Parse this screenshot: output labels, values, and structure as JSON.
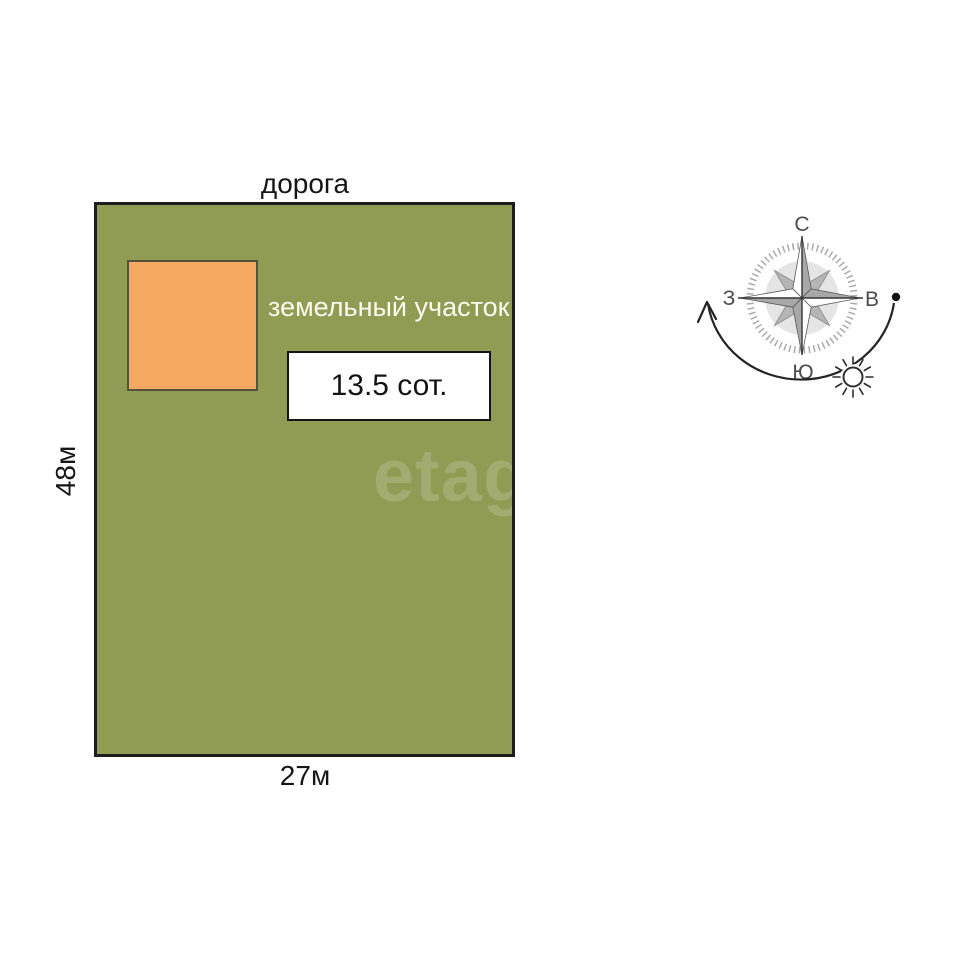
{
  "diagram": {
    "road_label": "дорога",
    "plot_label": "земельный участок",
    "area_label": "13.5 сот.",
    "height_label": "48м",
    "width_label": "27м",
    "watermark": "etagi",
    "colors": {
      "plot_fill": "#909b53",
      "plot_border": "#1d1d1d",
      "building_fill": "#f6a963",
      "area_box_bg": "#ffffff",
      "label_on_plot": "#fbfbf0",
      "text_dark": "#141414"
    }
  },
  "compass": {
    "north_label": "С",
    "east_label": "В",
    "south_label": "Ю",
    "west_label": "З"
  }
}
